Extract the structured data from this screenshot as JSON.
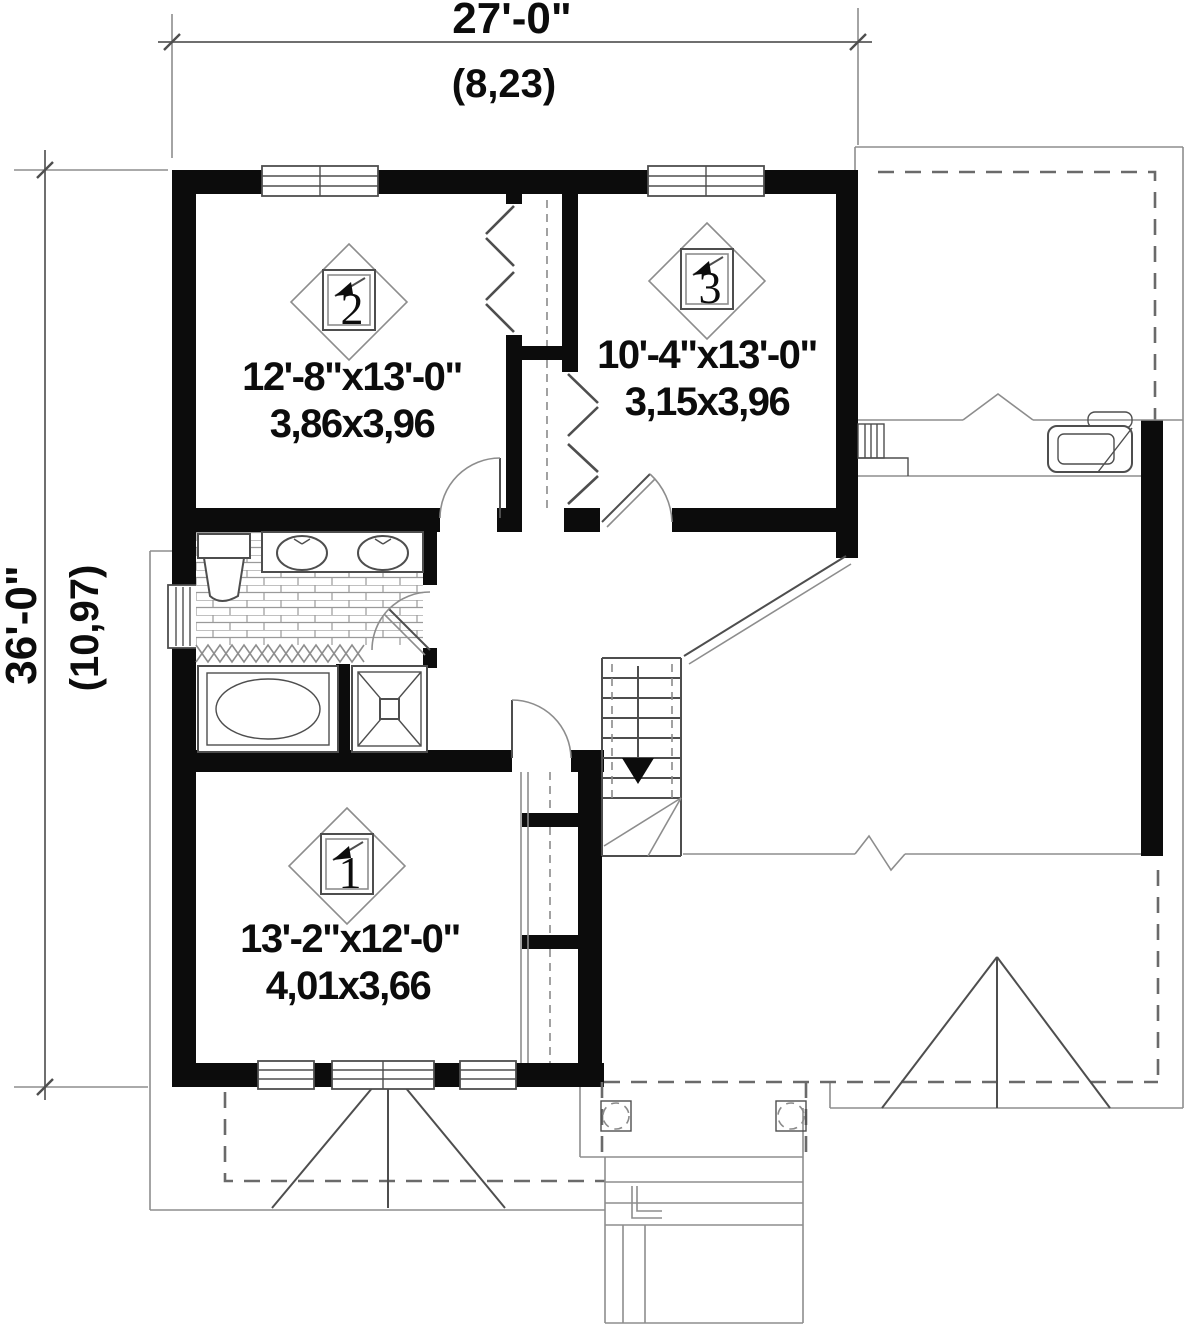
{
  "dimensions": {
    "width": {
      "imperial": "27'-0\"",
      "metric": "(8,23)"
    },
    "depth": {
      "imperial": "36'-0\"",
      "metric": "(10,97)"
    }
  },
  "rooms": {
    "bedroom1": {
      "number": "1",
      "size_imperial": "13'-2\"x12'-0\"",
      "size_metric": "4,01x3,66"
    },
    "bedroom2": {
      "number": "2",
      "size_imperial": "12'-8\"x13'-0\"",
      "size_metric": "3,86x3,96"
    },
    "bedroom3": {
      "number": "3",
      "size_imperial": "10'-4\"x13'-0\"",
      "size_metric": "3,15x3,96"
    }
  },
  "colors": {
    "wall": "#0c0c0c",
    "line": "#4e4e4e",
    "light_line": "#8d8d8d",
    "background": "#ffffff"
  }
}
